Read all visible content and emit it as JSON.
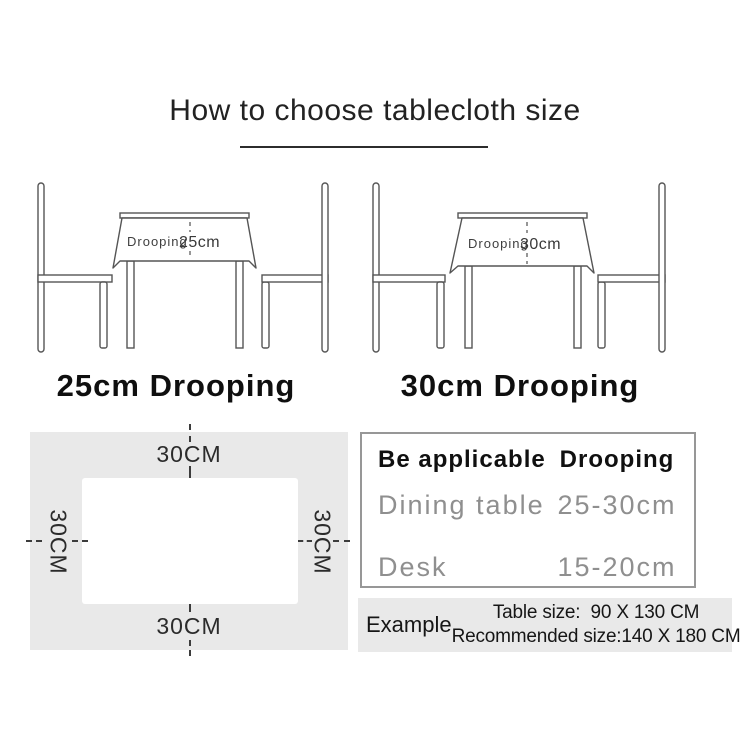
{
  "title": "How to choose tablecloth size",
  "illustrations": [
    {
      "cloth_word": "Drooping",
      "cloth_value": "25cm",
      "caption": "25cm Drooping"
    },
    {
      "cloth_word": "Drooping",
      "cloth_value": "30cm",
      "caption": "30cm Drooping"
    }
  ],
  "size_diagram": {
    "top_label": "30CM",
    "bottom_label": "30CM",
    "left_label": "30CM",
    "right_label": "30CM"
  },
  "spec_table": {
    "header": {
      "applicable": "Be applicable",
      "drooping": "Drooping"
    },
    "rows": [
      {
        "applicable": "Dining table",
        "drooping": "25-30cm"
      },
      {
        "applicable": "Desk",
        "drooping": "15-20cm"
      }
    ]
  },
  "example": {
    "label": "Example",
    "table_size_line": "Table size:  90 X 130 CM",
    "recommended_line": "Recommended size:140 X 180 CM"
  },
  "colors": {
    "ink": "#1a1a1a",
    "line_stroke": "#555555",
    "panel_bg": "#e9e9e9",
    "muted_text": "#8f8f8f",
    "table_border": "#979797"
  }
}
